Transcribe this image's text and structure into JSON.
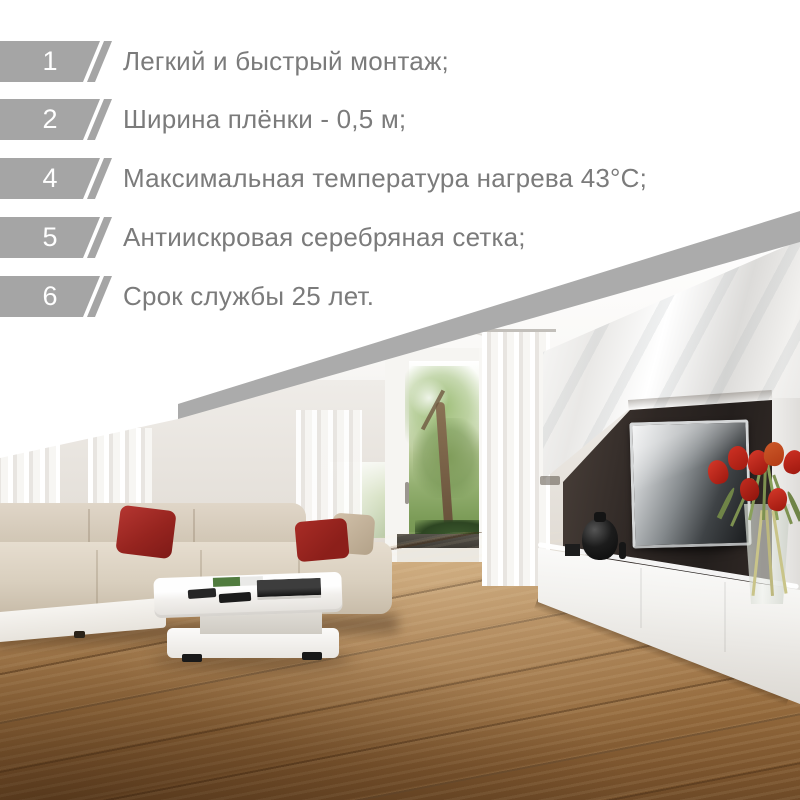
{
  "features": {
    "items": [
      {
        "number": "1",
        "text": "Легкий и быстрый монтаж;"
      },
      {
        "number": "2",
        "text": "Ширина плёнки - 0,5 м;"
      },
      {
        "number": "4",
        "text": "Максимальная температура нагрева 43°C;"
      },
      {
        "number": "5",
        "text": "Антиискровая серебряная сетка;"
      },
      {
        "number": "6",
        "text": "Срок службы 25 лет."
      }
    ]
  },
  "colors": {
    "background": "#ffffff",
    "badge_gray": "#a5a5a5",
    "band_gray": "#ababab",
    "text_gray": "#7b7b7b",
    "accent_red": "#9c2823",
    "wood_brown": "#96713f",
    "sofa_beige": "#d8cebf"
  }
}
